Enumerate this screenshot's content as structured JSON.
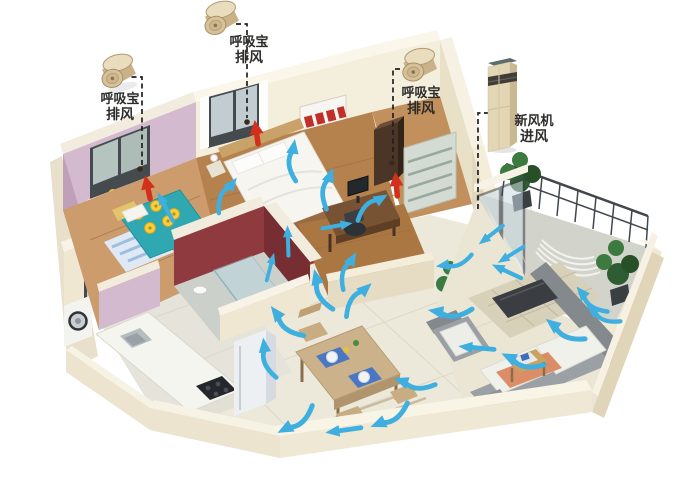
{
  "diagram": {
    "type": "3d-isometric-floorplan-ventilation",
    "labels": {
      "exhaust_left": {
        "line1": "呼吸宝",
        "line2": "排风"
      },
      "exhaust_top": {
        "line1": "呼吸宝",
        "line2": "排风"
      },
      "exhaust_right": {
        "line1": "呼吸宝",
        "line2": "排风"
      },
      "fresh_air": {
        "line1": "新风机",
        "line2": "进风"
      }
    },
    "devices": [
      {
        "id": "exhaust-puck-left",
        "kind": "呼吸宝",
        "function": "排风"
      },
      {
        "id": "exhaust-puck-top",
        "kind": "呼吸宝",
        "function": "排风"
      },
      {
        "id": "exhaust-puck-right",
        "kind": "呼吸宝",
        "function": "排风"
      },
      {
        "id": "fresh-air-unit",
        "kind": "新风机",
        "function": "进风"
      }
    ],
    "airflow": {
      "blue_arrow_count": 27,
      "red_exhaust_arrow_count": 3,
      "dashed_leader_count": 4
    },
    "colors": {
      "airflow_blue": "#3fafe0",
      "exhaust_red": "#d2301c",
      "wall_cream": "#f3ecd9",
      "wall_pink": "#d3bacf",
      "wall_maroon": "#8e3a3e",
      "device_gold": "#cdb289",
      "background": "#ffffff"
    }
  }
}
